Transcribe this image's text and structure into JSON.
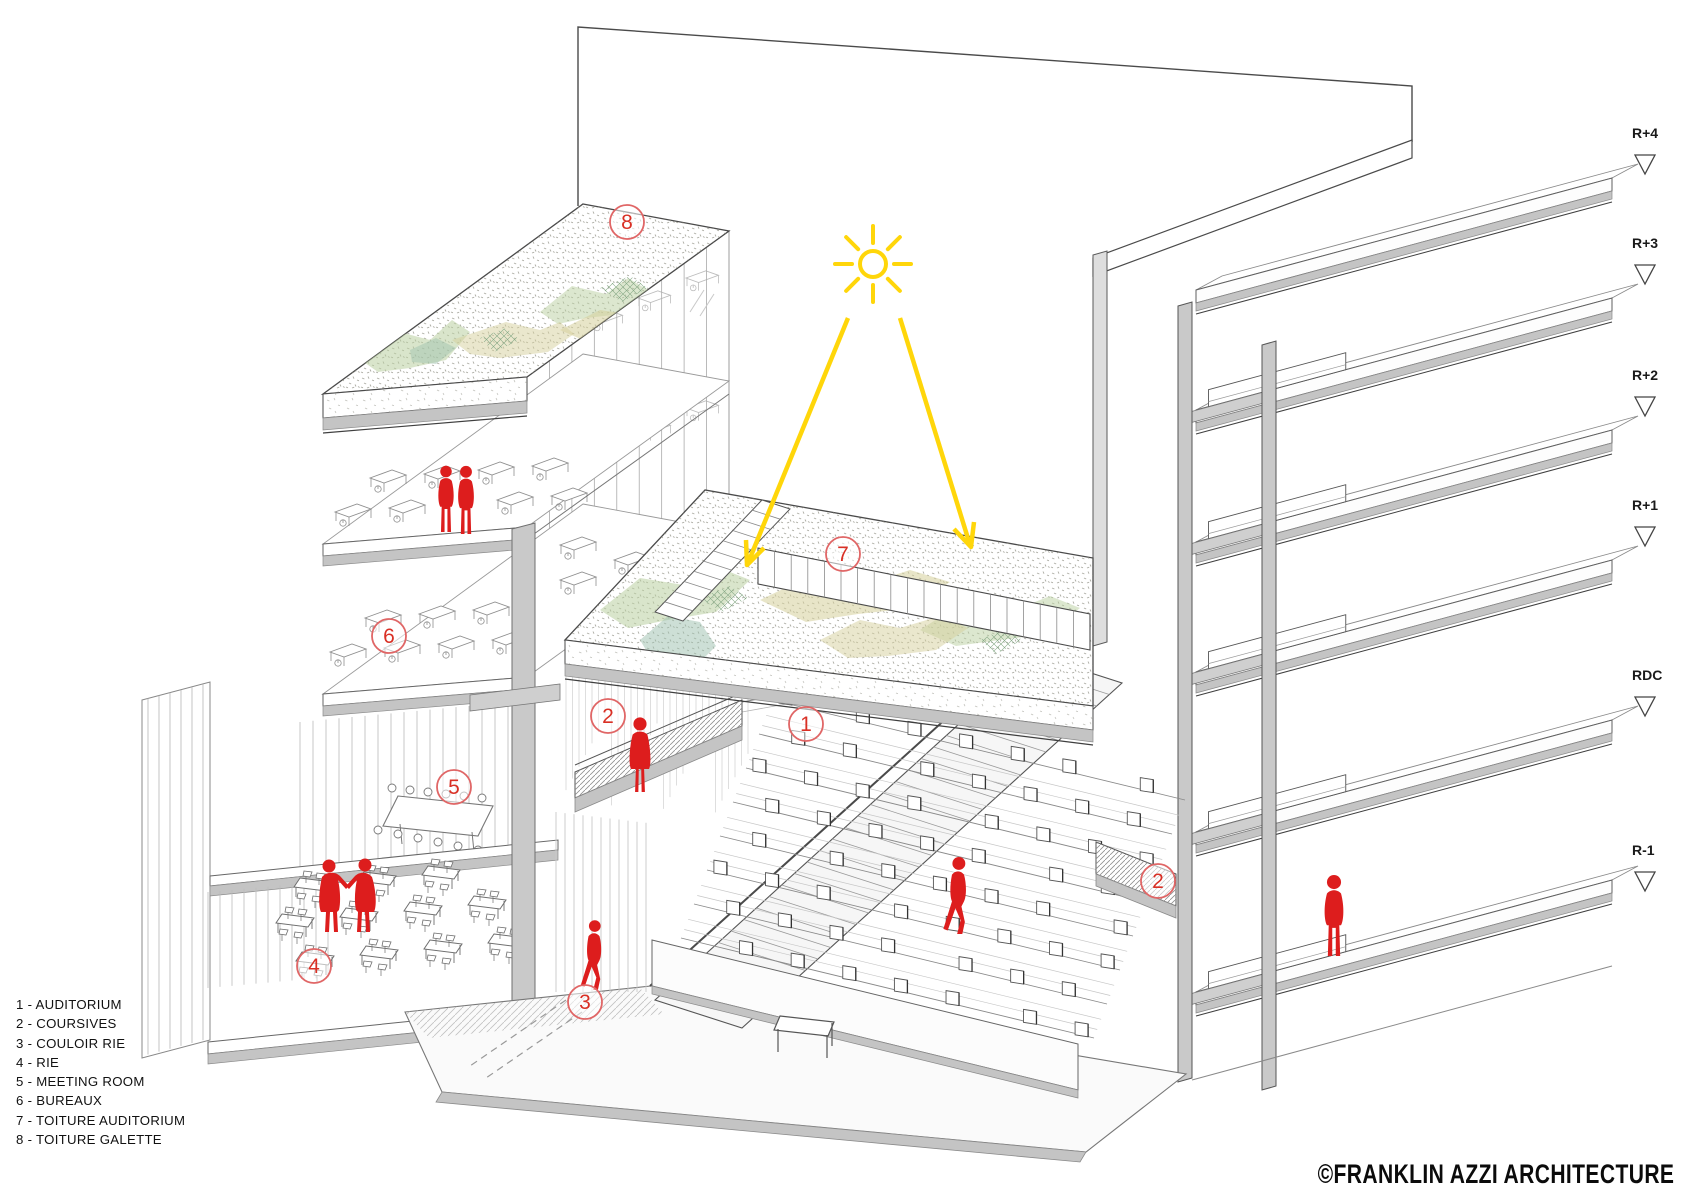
{
  "page": {
    "legend": {
      "items": [
        "1 - AUDITORIUM",
        "2 - COURSIVES",
        "3 - COULOIR RIE",
        "4 - RIE",
        "5 - MEETING ROOM",
        "6 - BUREAUX",
        "7 - TOITURE AUDITORIUM",
        "8 - TOITURE GALETTE"
      ]
    },
    "levels": [
      "R+4",
      "R+3",
      "R+2",
      "R+1",
      "RDC",
      "R-1"
    ],
    "markers": [
      {
        "id": "m1",
        "n": "1"
      },
      {
        "id": "m2a",
        "n": "2"
      },
      {
        "id": "m2b",
        "n": "2"
      },
      {
        "id": "m3",
        "n": "3"
      },
      {
        "id": "m4",
        "n": "4"
      },
      {
        "id": "m5",
        "n": "5"
      },
      {
        "id": "m6",
        "n": "6"
      },
      {
        "id": "m7",
        "n": "7"
      },
      {
        "id": "m8",
        "n": "8"
      }
    ],
    "copyright": "©FRANKLIN AZZI ARCHITECTURE",
    "colors": {
      "figure_red": "#dd1d1d",
      "marker_red": "#d93025",
      "marker_ring": "#e06666",
      "sun_yellow": "#ffd60a",
      "slab_gray": "#c4c4c4",
      "green_sage": "#b9cfa0",
      "green_olive": "#d6cf9b",
      "green_teal": "#9cbfad"
    }
  }
}
